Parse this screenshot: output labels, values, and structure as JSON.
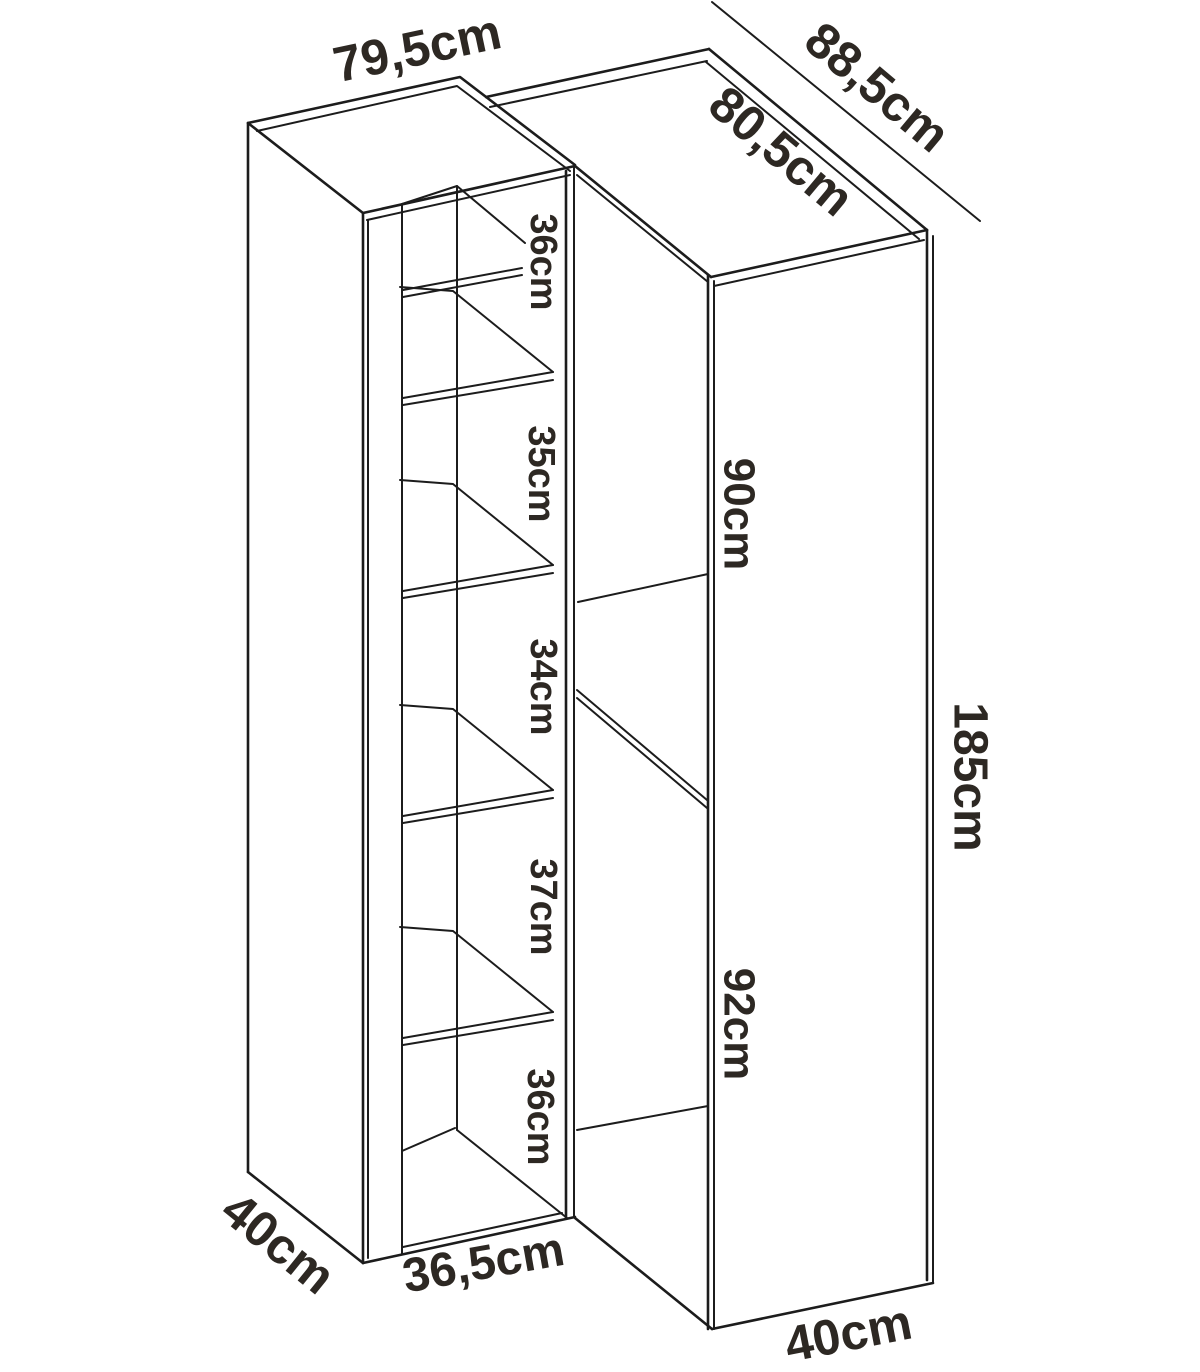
{
  "diagram": {
    "left_unit": {
      "width_label": "79,5cm",
      "depth_label": "40cm",
      "opening_width_label": "36,5cm",
      "compartment_labels": [
        "36cm",
        "35cm",
        "34cm",
        "37cm",
        "36cm"
      ]
    },
    "corner_unit": {
      "back_width_label": "88,5cm",
      "top_depth_label": "80,5cm",
      "upper_section_label": "90cm",
      "lower_section_label": "92cm",
      "height_label": "185cm",
      "side_depth_label": "40cm"
    },
    "colors": {
      "line": "#1c1c1c",
      "label_text": "#2d2823",
      "background": "#ffffff"
    }
  }
}
